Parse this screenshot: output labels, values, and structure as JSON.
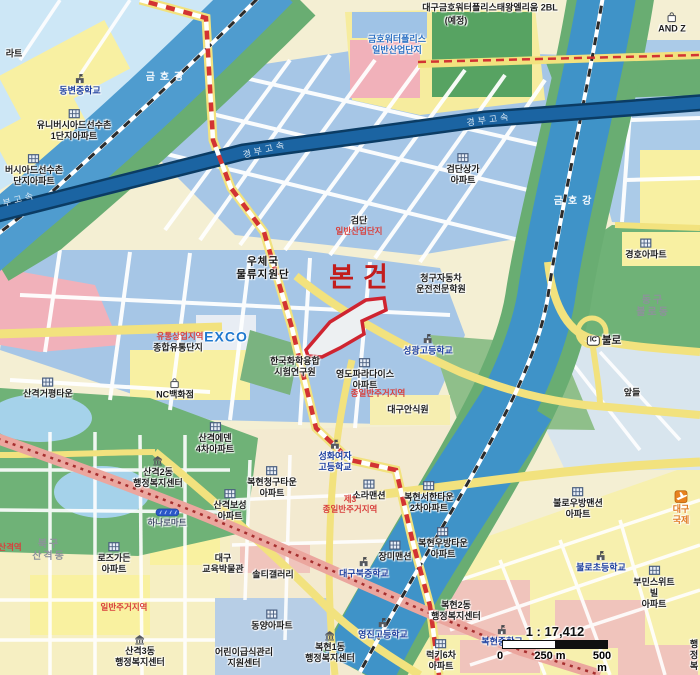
{
  "map": {
    "subject_marker": "본건",
    "scale": {
      "ratio": "1 : 17,412",
      "ticks": [
        "0",
        "250 m",
        "500 m"
      ]
    },
    "colors": {
      "site_outline": "#cf2430",
      "zoning_text": "#d8403d",
      "school_text": "#1d3f9e",
      "river": "#4f9ccf",
      "expressway": "#1b64a2",
      "park": "#6fb277",
      "industrial_block": "#a6c6e6",
      "residential_block": "#f8f0a2",
      "arterial_road": "#eba69e",
      "boundary_dash": "#d23333"
    },
    "labels": [
      {
        "n": "apt-label-fragment",
        "t": "라트",
        "x": 14,
        "y": 54,
        "k": "pl"
      },
      {
        "n": "dongbyeon-middle-school",
        "t": "동변중학교",
        "x": 80,
        "y": 85,
        "k": "sch",
        "i": "school"
      },
      {
        "n": "universiade-village-1-apt",
        "t": "유니버시아드선수촌\n1단지아파트",
        "x": 74,
        "y": 125,
        "k": "pl",
        "i": "apt"
      },
      {
        "n": "universiade-village-2-apt",
        "t": "버시아드선수촌\n단지아파트",
        "x": 34,
        "y": 170,
        "k": "pl",
        "i": "apt"
      },
      {
        "n": "geumho-river-label-west",
        "t": "금호강",
        "x": 167,
        "y": 78,
        "k": "riv"
      },
      {
        "n": "geumho-river-label-east",
        "t": "금호강",
        "x": 575,
        "y": 202,
        "k": "riv"
      },
      {
        "n": "gyeongbu-expressway-label-1",
        "t": "경부고속",
        "x": 265,
        "y": 150,
        "k": "hwy",
        "r": -14
      },
      {
        "n": "gyeongbu-expressway-label-2",
        "t": "경부고속",
        "x": 489,
        "y": 120,
        "k": "hwy",
        "r": -8
      },
      {
        "n": "gyeongbu-expressway-label-3",
        "t": "경부고속",
        "x": 14,
        "y": 201,
        "k": "hwy",
        "r": -15
      },
      {
        "n": "waterpolis-banner-line1",
        "t": "대구금호워터폴리스태왕엘리움 2BL",
        "x": 490,
        "y": 8,
        "k": "pl"
      },
      {
        "n": "waterpolis-banner-line2",
        "t": "(예정)",
        "x": 456,
        "y": 21,
        "k": "pl"
      },
      {
        "n": "waterpolis-industrial-complex",
        "t": "금호워터폴리스\n일반산업단지",
        "x": 397,
        "y": 45,
        "k": "blueb"
      },
      {
        "n": "and-z-store",
        "t": "AND Z",
        "x": 672,
        "y": 23,
        "k": "pl",
        "i": "shop"
      },
      {
        "n": "geomdan-sangga-apt",
        "t": "검단상가\n아파트",
        "x": 463,
        "y": 169,
        "k": "pl",
        "i": "apt"
      },
      {
        "n": "geomdan-name",
        "t": "검단",
        "x": 359,
        "y": 221,
        "k": "pl"
      },
      {
        "n": "geomdan-industrial-zone",
        "t": "일반산업단지",
        "x": 359,
        "y": 231,
        "k": "zone"
      },
      {
        "n": "post-office-logistics",
        "t": "우체국\n물류지원단",
        "x": 263,
        "y": 268,
        "k": "plmd"
      },
      {
        "n": "subject-property-label",
        "t": "본건",
        "x": 363,
        "y": 278,
        "k": "subj"
      },
      {
        "n": "chunggu-driving-school",
        "t": "청구자동차\n운전전문학원",
        "x": 441,
        "y": 284,
        "k": "pl"
      },
      {
        "n": "seonggwang-high-school",
        "t": "성광고등학교",
        "x": 428,
        "y": 345,
        "k": "sch",
        "i": "school"
      },
      {
        "n": "exco",
        "t": "EXCO",
        "x": 226,
        "y": 337,
        "k": "bluebig"
      },
      {
        "n": "distribution-commercial-zone",
        "t": "유통상업지역",
        "x": 180,
        "y": 336,
        "k": "zone"
      },
      {
        "n": "distribution-complex",
        "t": "종합유통단지",
        "x": 178,
        "y": 348,
        "k": "pl"
      },
      {
        "n": "ktr-institute",
        "t": "한국화학융합\n시험연구원",
        "x": 295,
        "y": 367,
        "k": "pl"
      },
      {
        "n": "yeongdo-paradise-apt",
        "t": "영도파라다이스\n아파트",
        "x": 365,
        "y": 374,
        "k": "pl",
        "i": "apt"
      },
      {
        "n": "residential-zone-center",
        "t": "종일반주거지역",
        "x": 378,
        "y": 393,
        "k": "zone"
      },
      {
        "n": "daegu-ansikwon",
        "t": "대구안식원",
        "x": 408,
        "y": 410,
        "k": "pl"
      },
      {
        "n": "nc-department-store",
        "t": "NC백화점",
        "x": 175,
        "y": 389,
        "k": "pl",
        "i": "shop"
      },
      {
        "n": "sangyeok-geopyeong-town",
        "t": "산격거평타운",
        "x": 48,
        "y": 388,
        "k": "pl",
        "i": "apt"
      },
      {
        "n": "gyeongho-apt",
        "t": "경호아파트",
        "x": 646,
        "y": 249,
        "k": "pl",
        "i": "apt"
      },
      {
        "n": "dong-gu-bullo-dong",
        "t": "동구\n불로동",
        "x": 653,
        "y": 307,
        "k": "dist"
      },
      {
        "n": "bullo-ic",
        "t": "불로",
        "x": 604,
        "y": 341,
        "k": "plb",
        "b": "IC"
      },
      {
        "n": "apdeul-field",
        "t": "앞들",
        "x": 632,
        "y": 393,
        "k": "pl"
      },
      {
        "n": "sangyeok-eden-4-apt",
        "t": "산격에덴\n4차아파트",
        "x": 215,
        "y": 438,
        "k": "pl",
        "i": "apt"
      },
      {
        "n": "sangyeok-2-dong-admin-center",
        "t": "산격2동\n행정복지센터",
        "x": 158,
        "y": 472,
        "k": "pl",
        "i": "gov"
      },
      {
        "n": "sangyeok-boseong-apt",
        "t": "산격보성\n아파트",
        "x": 230,
        "y": 505,
        "k": "pl",
        "i": "apt"
      },
      {
        "n": "hanaro-mart",
        "t": "하나로마트",
        "x": 167,
        "y": 518,
        "k": "plsm",
        "i": "mart"
      },
      {
        "n": "buk-gu-sangyeok-dong",
        "t": "북구\n산격동",
        "x": 49,
        "y": 551,
        "k": "dist"
      },
      {
        "n": "rose-garden-apt",
        "t": "로즈가든\n아파트",
        "x": 114,
        "y": 558,
        "k": "pl",
        "i": "apt"
      },
      {
        "n": "daegu-education-museum",
        "t": "대구\n교육박물관",
        "x": 223,
        "y": 564,
        "k": "pl"
      },
      {
        "n": "solti-gallery",
        "t": "솔티갤러리",
        "x": 273,
        "y": 575,
        "k": "pl"
      },
      {
        "n": "dongyang-apt",
        "t": "동양아파트",
        "x": 272,
        "y": 620,
        "k": "pl",
        "i": "apt"
      },
      {
        "n": "sangyeok-3-dong-admin-center",
        "t": "산격3동\n행정복지센터",
        "x": 140,
        "y": 651,
        "k": "pl",
        "i": "gov"
      },
      {
        "n": "children-food-support-center",
        "t": "어린이급식관리\n지원센터",
        "x": 244,
        "y": 658,
        "k": "pl"
      },
      {
        "n": "residential-zone-west",
        "t": "일반주거지역",
        "x": 124,
        "y": 607,
        "k": "zone"
      },
      {
        "n": "sangyeok-station",
        "t": "산격역",
        "x": 10,
        "y": 547,
        "k": "zone"
      },
      {
        "n": "bokhyeon-chunggu-town-apt",
        "t": "복현청구타운\n아파트",
        "x": 272,
        "y": 482,
        "k": "pl",
        "i": "apt"
      },
      {
        "n": "sora-mansion",
        "t": "소라맨션",
        "x": 369,
        "y": 490,
        "k": "pl",
        "i": "apt"
      },
      {
        "n": "residential-zone-class3",
        "t": "제3\n종일반주거지역",
        "x": 350,
        "y": 504,
        "k": "zone"
      },
      {
        "n": "jangmi-mansion",
        "t": "장미맨션",
        "x": 395,
        "y": 551,
        "k": "pl",
        "i": "apt"
      },
      {
        "n": "bokhyeon-seohan-town-2-apt",
        "t": "복현서한타운\n2차아파트",
        "x": 429,
        "y": 497,
        "k": "pl",
        "i": "apt"
      },
      {
        "n": "bokhyeon-ubang-town-apt",
        "t": "복현우방타운\n아파트",
        "x": 443,
        "y": 543,
        "k": "pl",
        "i": "apt"
      },
      {
        "n": "daegu-buk-middle-school",
        "t": "대구북중학교",
        "x": 364,
        "y": 568,
        "k": "sch",
        "i": "school"
      },
      {
        "n": "yeongjin-high-school",
        "t": "영진고등학교",
        "x": 383,
        "y": 629,
        "k": "sch",
        "i": "school"
      },
      {
        "n": "bokhyeon-1-dong-admin-center",
        "t": "복현1동\n행정복지센터",
        "x": 330,
        "y": 647,
        "k": "pl",
        "i": "gov"
      },
      {
        "n": "bokhyeon-2-dong-admin-center",
        "t": "복현2동\n행정복지센터",
        "x": 456,
        "y": 611,
        "k": "pl"
      },
      {
        "n": "lucky-6-apt",
        "t": "럭키6차\n아파트",
        "x": 441,
        "y": 655,
        "k": "pl",
        "i": "apt"
      },
      {
        "n": "bokhyeon-middle-school",
        "t": "복현중학교",
        "x": 502,
        "y": 636,
        "k": "sch",
        "i": "school"
      },
      {
        "n": "bullo-ubang-mansion-apt",
        "t": "불로우방맨션\n아파트",
        "x": 578,
        "y": 503,
        "k": "pl",
        "i": "apt"
      },
      {
        "n": "bullo-elementary-school",
        "t": "불로초등학교",
        "x": 601,
        "y": 562,
        "k": "sch",
        "i": "school"
      },
      {
        "n": "bumin-sweetville-apt",
        "t": "부민스위트빌\n아파트",
        "x": 654,
        "y": 587,
        "k": "pl",
        "i": "apt"
      },
      {
        "n": "daegu-international-airport",
        "t": "대구국제",
        "x": 681,
        "y": 508,
        "k": "org",
        "i": "air"
      },
      {
        "n": "seonghwa-girls-high-school",
        "t": "성화여자\n고등학교",
        "x": 335,
        "y": 456,
        "k": "sch",
        "i": "school"
      },
      {
        "n": "admin-center-fragment",
        "t": "행정복",
        "x": 694,
        "y": 655,
        "k": "pl"
      }
    ]
  }
}
